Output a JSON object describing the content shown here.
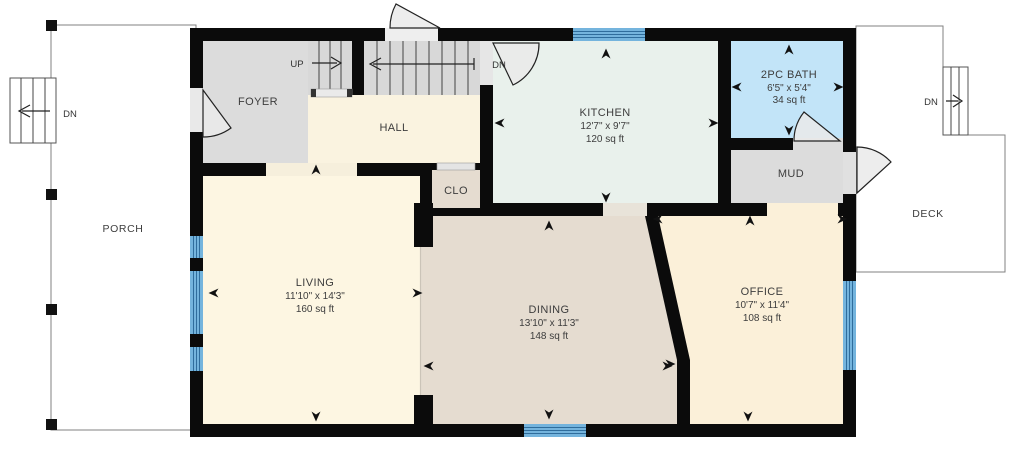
{
  "floor_plan": {
    "rooms": {
      "porch": {
        "name": "PORCH"
      },
      "foyer": {
        "name": "FOYER"
      },
      "hall": {
        "name": "HALL"
      },
      "closet": {
        "name": "CLO"
      },
      "kitchen": {
        "name": "KITCHEN",
        "dimensions": "12'7\" x 9'7\"",
        "area": "120 sq ft"
      },
      "bath": {
        "name": "2PC BATH",
        "dimensions": "6'5\" x 5'4\"",
        "area": "34 sq ft"
      },
      "mud": {
        "name": "MUD"
      },
      "living": {
        "name": "LIVING",
        "dimensions": "11'10\" x 14'3\"",
        "area": "160 sq ft"
      },
      "dining": {
        "name": "DINING",
        "dimensions": "13'10\" x 11'3\"",
        "area": "148 sq ft"
      },
      "office": {
        "name": "OFFICE",
        "dimensions": "10'7\" x 11'4\"",
        "area": "108 sq ft"
      },
      "deck": {
        "name": "DECK"
      }
    },
    "stairs": {
      "interior_up": {
        "label": "UP"
      },
      "interior_down": {
        "label": "DN"
      },
      "porch_down": {
        "label": "DN"
      },
      "deck_down": {
        "label": "DN"
      }
    },
    "colors": {
      "wall": "#0b0b0b",
      "window": "#74b4dd",
      "foyer": "#dcdcdc",
      "mud": "#dcdcdc",
      "stairs": "#d8d8d8",
      "hall": "#faf3e0",
      "living": "#fdf6e2",
      "office": "#fbf0d9",
      "dining": "#e5dcd0",
      "closet": "#e5dcd0",
      "kitchen": "#e9f1ec",
      "bath": "#c2e4f8",
      "exterior": "#ffffff"
    }
  }
}
